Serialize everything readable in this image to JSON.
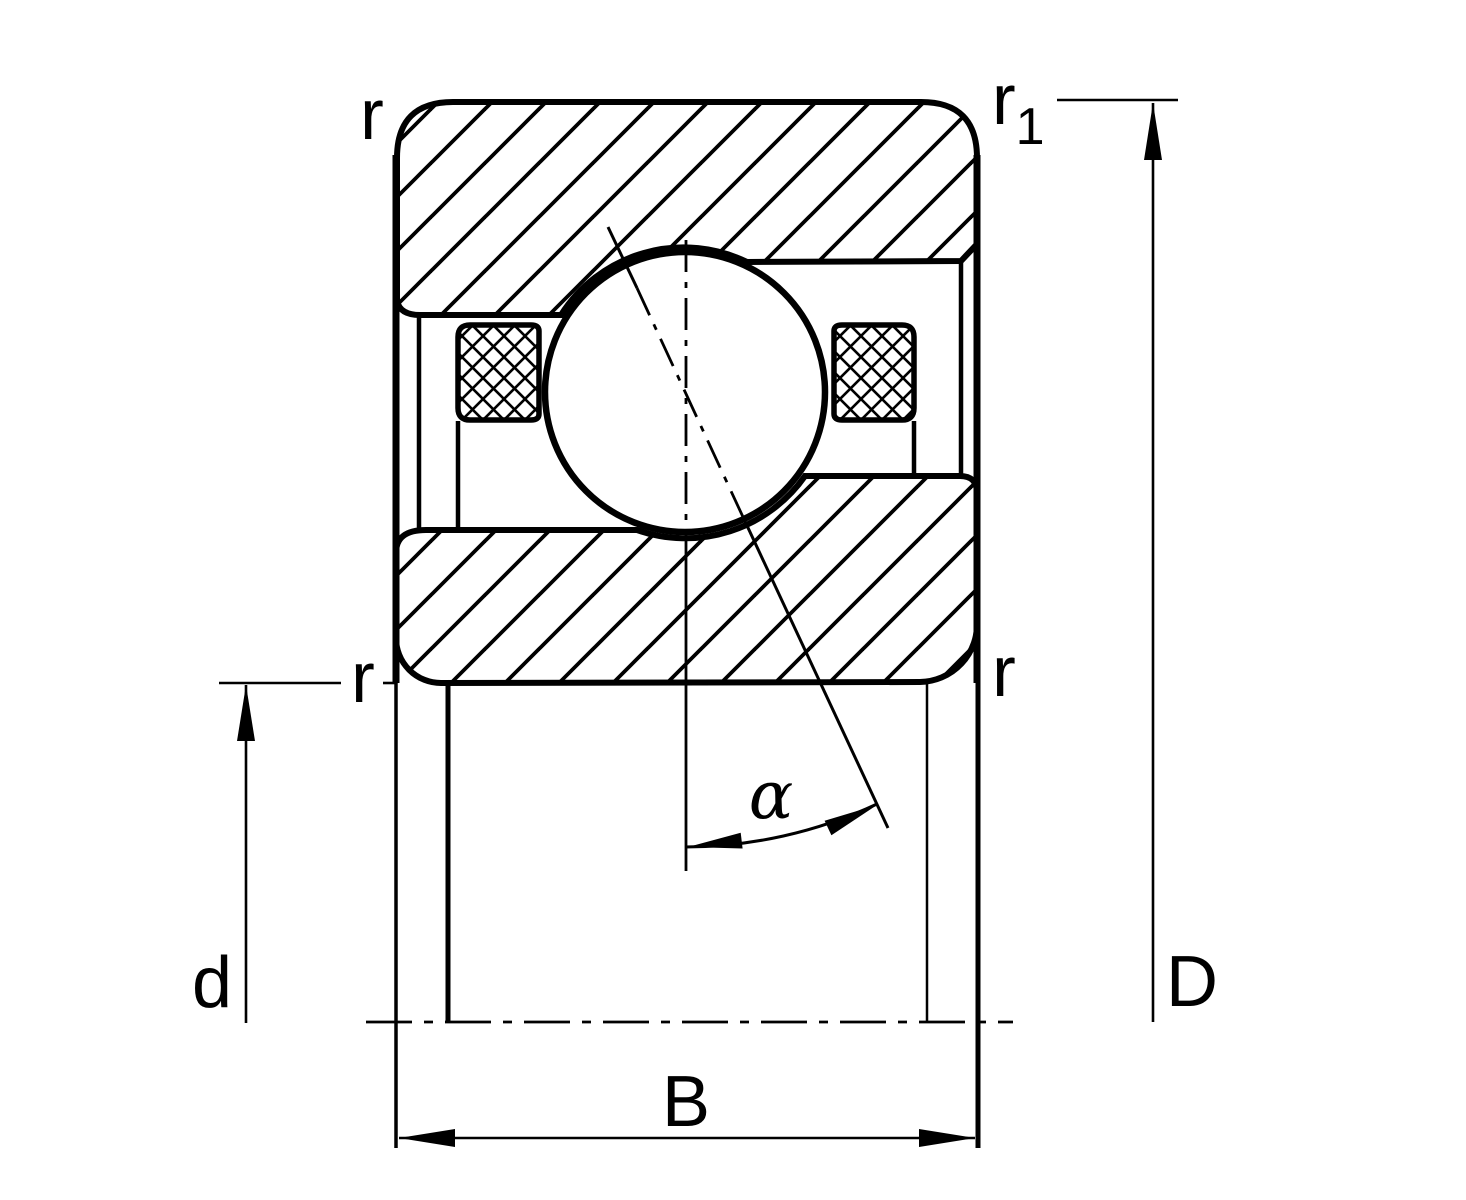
{
  "diagram": {
    "description": "Cross-section drawing of a single-row angular contact ball bearing with seals",
    "colors": {
      "line": "#000000",
      "background": "#ffffff"
    },
    "labels": {
      "chamfer_top_left": "r",
      "chamfer_top_right_base": "r",
      "chamfer_top_right_sub": "1",
      "chamfer_bottom_left": "r",
      "chamfer_bottom_right": "r",
      "bore_diameter": "d",
      "outside_diameter": "D",
      "width": "B",
      "contact_angle": "α"
    }
  }
}
